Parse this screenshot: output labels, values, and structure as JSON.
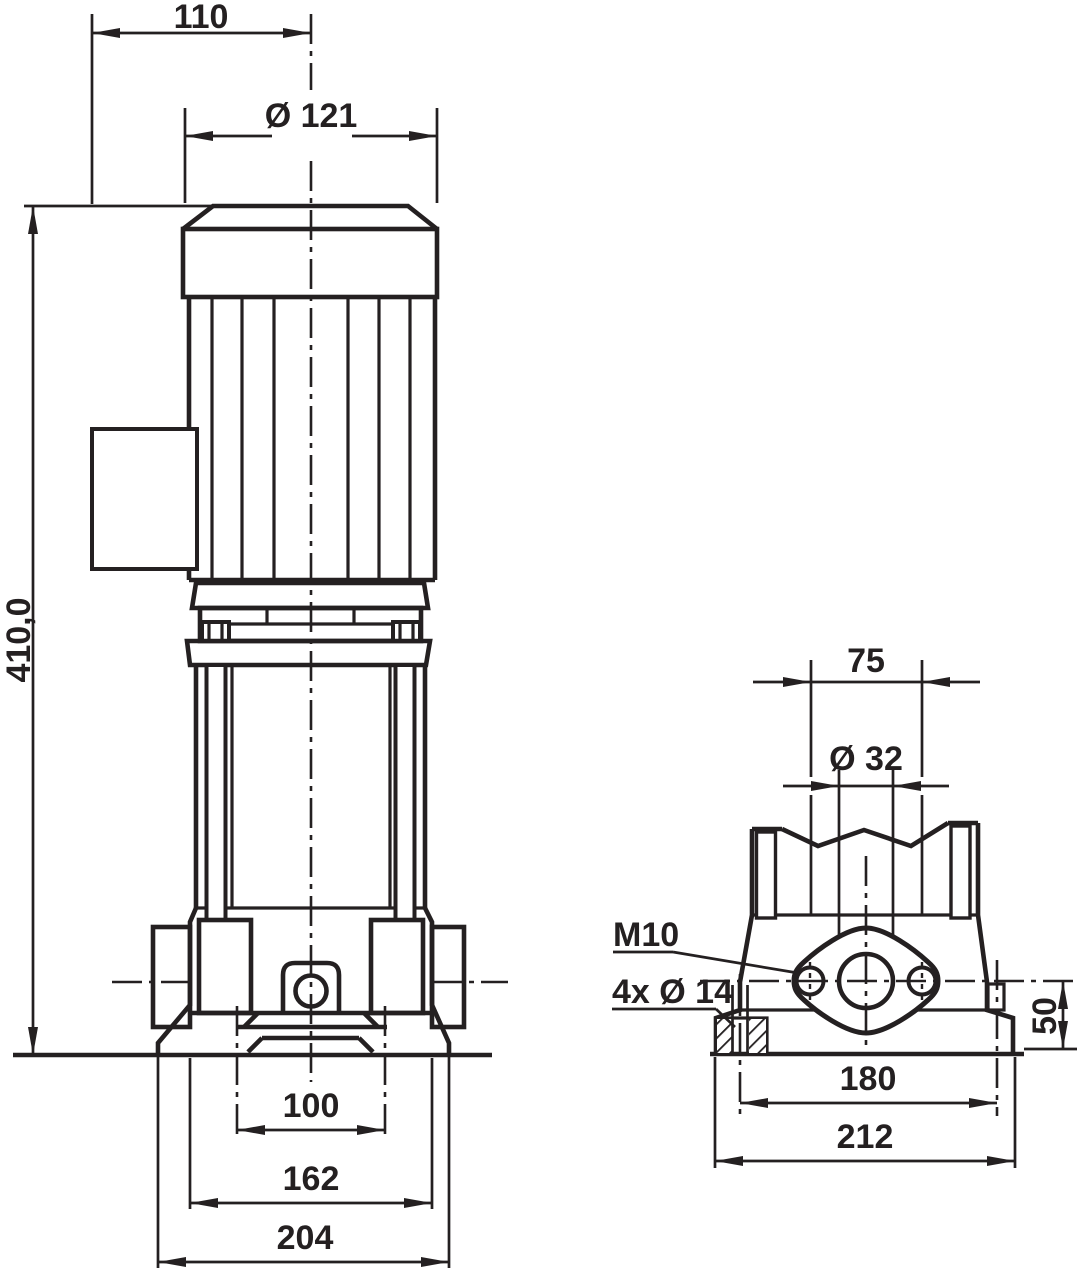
{
  "drawing_title": "pump-dimensional-drawing",
  "colors": {
    "ink": "#242021",
    "background": "#ffffff"
  },
  "front": {
    "dim_motor_offset": "110",
    "dim_motor_diameter": "Ø 121",
    "dim_total_height": "410,0",
    "dim_foot_hole_spacing": "100",
    "dim_base_mid_width": "162",
    "dim_base_width": "204"
  },
  "side": {
    "dim_port_spacing": "75",
    "dim_port_diameter": "Ø 32",
    "label_thread": "M10",
    "label_foot_holes": "4x Ø 14",
    "dim_port_height": "50",
    "dim_foot_spacing": "180",
    "dim_base_width": "212"
  }
}
